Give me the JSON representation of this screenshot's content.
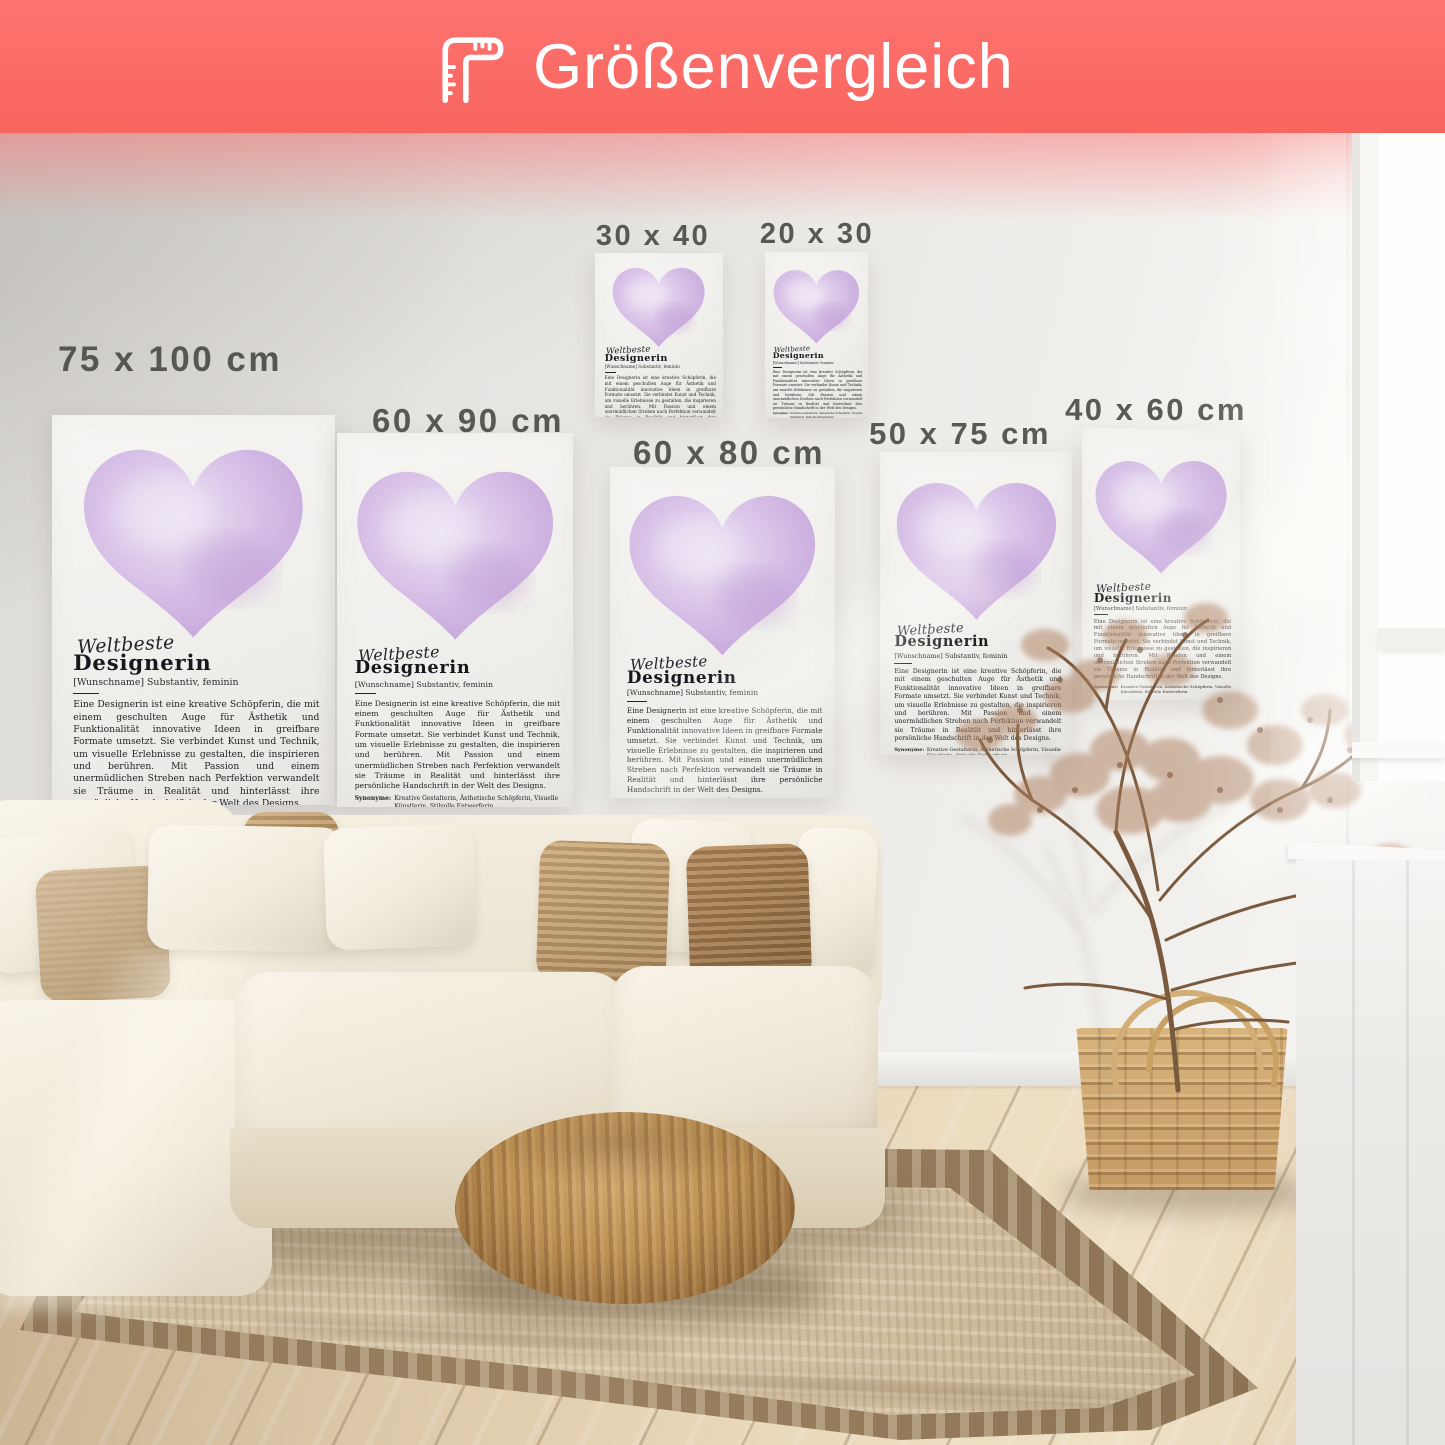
{
  "banner": {
    "title": "Größenvergleich",
    "icon": "corner-ruler-icon",
    "background_color": "#fc6e6c",
    "text_color": "#ffffff"
  },
  "posters": {
    "sizes": [
      {
        "label": "75 x 100 cm"
      },
      {
        "label": "60 x 90 cm"
      },
      {
        "label": "30 x 40 cm"
      },
      {
        "label": "20 x 30 cm"
      },
      {
        "label": "60 x 80 cm"
      },
      {
        "label": "50 x 75 cm"
      },
      {
        "label": "40 x 60 cm"
      }
    ],
    "content": {
      "script_title": "Weltbeste",
      "main_title": "Designerin",
      "subtitle": "[Wunschname] Substantiv, feminin",
      "body": "Eine Designerin ist eine kreative Schöpferin, die mit einem geschulten Auge für Ästhetik und Funktionalität innovative Ideen in greifbare Formate umsetzt. Sie verbindet Kunst und Technik, um visuelle Erlebnisse zu gestalten, die inspirieren und berühren. Mit Passion und einem unermüdlichen Streben nach Perfektion verwandelt sie Träume in Realität und hinterlässt ihre persönliche Handschrift in der Welt des Designs.",
      "synonyms_label": "Synonyme:",
      "synonyms_text": "Kreative Gestalterin, Ästhetische Schöpferin, Visuelle Künstlerin, Stilvolle Entwerferin.",
      "heart_color": "#cbaede"
    }
  }
}
